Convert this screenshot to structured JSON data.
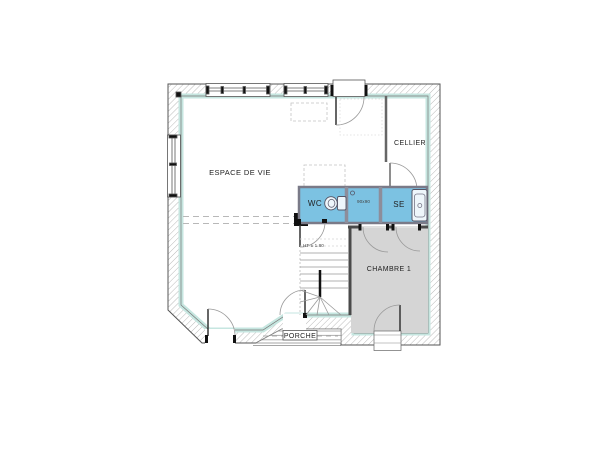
{
  "rooms": {
    "living": {
      "label": "ESPACE DE VIE"
    },
    "cellar": {
      "label": "CELLIER"
    },
    "wc": {
      "label": "WC"
    },
    "shower_room": {
      "label": "SE"
    },
    "bedroom1": {
      "label": "CHAMBRE 1"
    },
    "porch": {
      "label": "PORCHE"
    }
  },
  "annotations": {
    "shower_size": "90x90",
    "stair_headroom": "HT ± 1.80"
  },
  "colors": {
    "wet_room_fill": "#7cc2e2",
    "wet_room_wall": "#8d8d9a",
    "bedroom_fill": "#d5d5d5",
    "insulation_lining": "#c6e6e0",
    "wall_edge": "#555555"
  }
}
